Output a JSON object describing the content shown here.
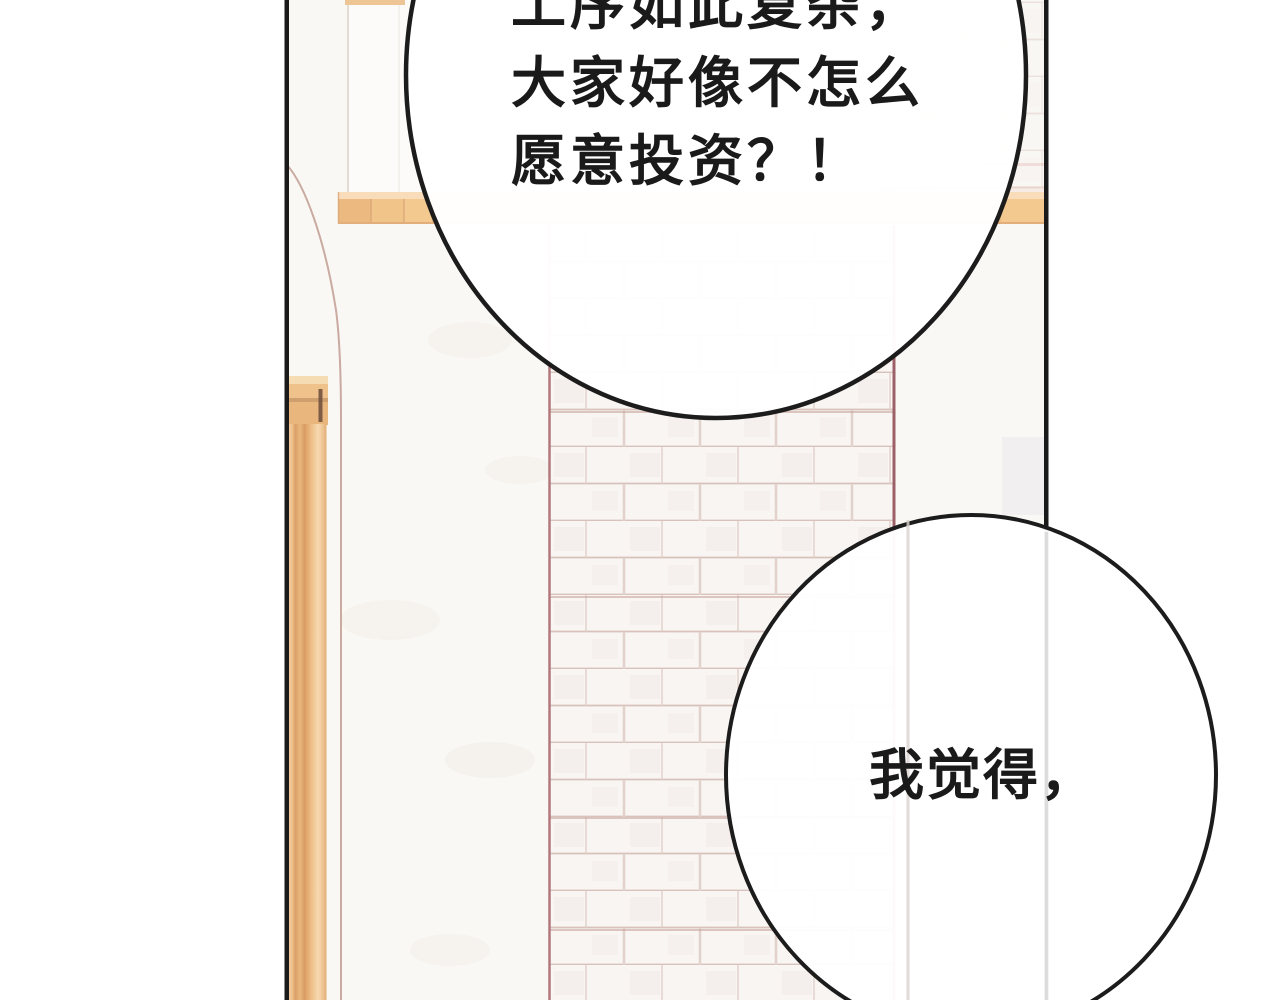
{
  "page": {
    "kind": "comic-panel",
    "margin_color": "#ffffff"
  },
  "panel": {
    "border_color": "#1a1a1a",
    "wall_color": "#faf8f5"
  },
  "palette": {
    "beam_tan": "#f4c98f",
    "beam_highlight": "#f9ddba",
    "beam_block_dark": "#ecba80",
    "beam_seam": "#d9a876",
    "column_gold": "#eab87f",
    "capital_band": "#efc28c",
    "capital_dark_accent": "#6b4b39",
    "brick_fill": "#f8f5f2",
    "brick_mortar": "#d8c2bb",
    "brick_edge_maroon": "#9d6066",
    "arch_line": "#c9aba1",
    "bubble_fill": "#ffffff",
    "bubble_outline": "#1c1c1c",
    "text_color": "#1a1a1a"
  },
  "bubbles": {
    "top": {
      "lines": [
        "工序如此复杂，",
        "大家好像不怎么",
        "愿意投资？！"
      ]
    },
    "bottom": {
      "lines": [
        "我觉得，"
      ]
    }
  }
}
